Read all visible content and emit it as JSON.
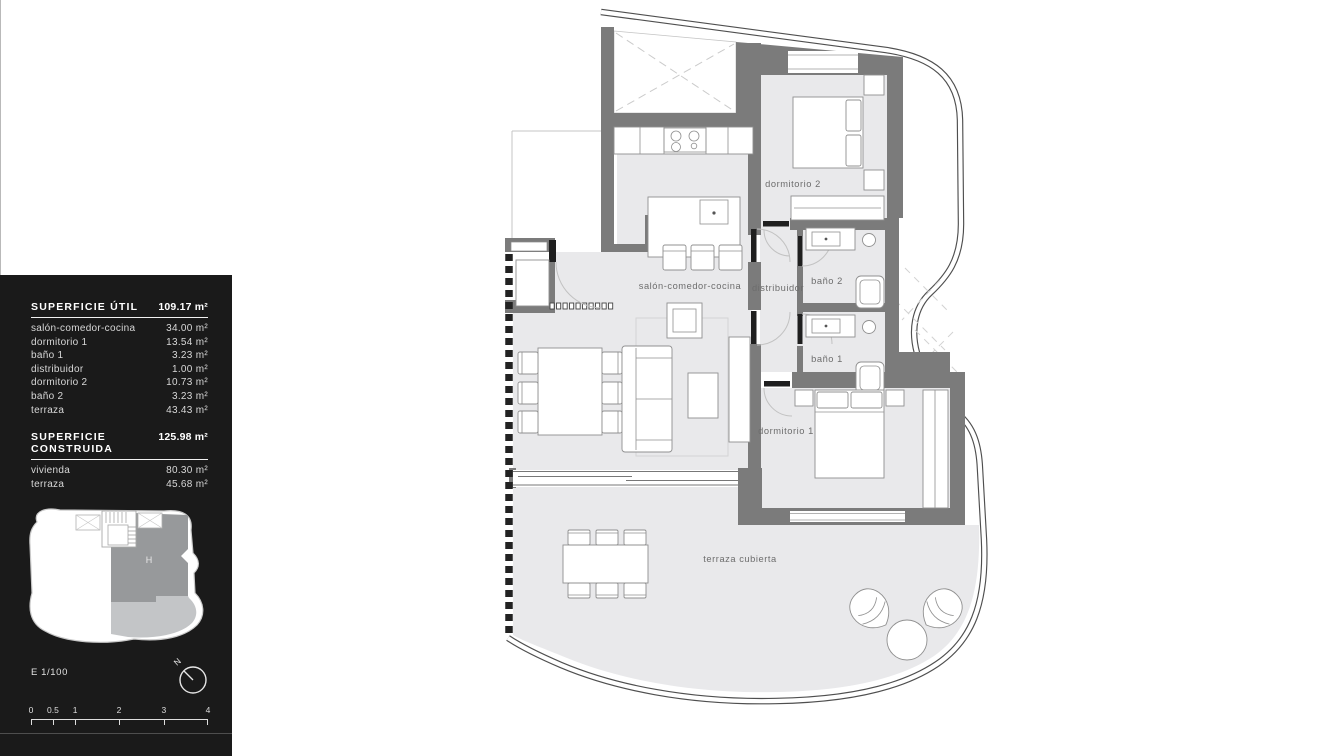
{
  "panel": {
    "util": {
      "title": "SUPERFICIE ÚTIL",
      "total": "109.17 m²",
      "rows": [
        {
          "label": "salón-comedor-cocina",
          "value": "34.00 m²"
        },
        {
          "label": "dormitorio 1",
          "value": "13.54 m²"
        },
        {
          "label": "baño 1",
          "value": "3.23 m²"
        },
        {
          "label": "distribuidor",
          "value": "1.00 m²"
        },
        {
          "label": "dormitorio 2",
          "value": "10.73 m²"
        },
        {
          "label": "baño 2",
          "value": "3.23 m²"
        },
        {
          "label": "terraza",
          "value": "43.43 m²"
        }
      ]
    },
    "construida": {
      "title": "SUPERFICIE CONSTRUIDA",
      "total": "125.98 m²",
      "rows": [
        {
          "label": "vivienda",
          "value": "80.30 m²"
        },
        {
          "label": "terraza",
          "value": "45.68 m²"
        }
      ]
    },
    "keyplan_unit": "H",
    "scale_text": "E 1/100",
    "north": "N",
    "scalebar": {
      "ticks": [
        "0",
        "0.5",
        "1",
        "2",
        "3",
        "4"
      ]
    }
  },
  "plan": {
    "labels": {
      "salon": "salón-comedor-cocina",
      "distribuidor": "distribuidor",
      "bano2": "baño 2",
      "bano1": "baño 1",
      "dorm2": "dormitorio 2",
      "dorm1": "dormitorio 1",
      "terraza": "terraza cubierta"
    }
  },
  "colors": {
    "wall": "#7b7b7b",
    "floor": "#e9e9eb",
    "panel_bg": "#1a1a1a",
    "keyplan_unit_fill": "#97999b",
    "keyplan_terrace_fill": "#c3c5c7"
  }
}
